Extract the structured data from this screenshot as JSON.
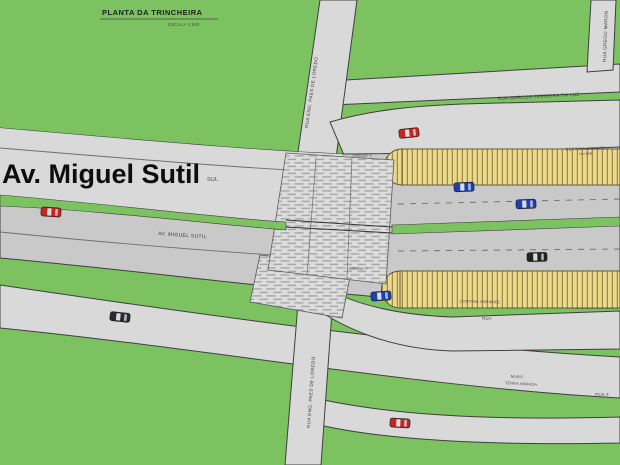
{
  "title": {
    "text": "PLANTA DA TRINCHEIRA",
    "subtitle": "ESCALA 1:500"
  },
  "overlay_label": {
    "text": "Av. Miguel Sutil",
    "suffix": "SUL"
  },
  "streets": {
    "avenue": "AV. MIGUEL SUTIL",
    "cross_street_north": "RUA ENG. PAES DE LOREDO",
    "cross_street_south": "RUA ENG. PAES DE LOREDO",
    "street_top_right": "RUA MARCOS FERREIRA DA LUZ",
    "street_far_right": "RUA GREGO MARON",
    "service_road": "RUA"
  },
  "annotations": {
    "upper_wall": "CORTINA VARIAVEL",
    "upper_wall_height": "H=VAR",
    "lower_wall": "CORTINA VARIAVEL",
    "grade_upper": "GREIDE 9",
    "grade_lower": "GREIDE 7",
    "retaining_wall_line1": "MURO",
    "retaining_wall_line2": "TERRA ARMADA",
    "sheet_ref": "PLN 4"
  },
  "colors": {
    "grass": "#7cc261",
    "road": "#d9d9d9",
    "road_dark": "#c9c9c9",
    "wall_yellow": "#ecd98b",
    "outline": "#3f3f3f"
  },
  "cars": [
    {
      "x": 409,
      "y": 133,
      "rot": -6,
      "color": "#c3271f"
    },
    {
      "x": 464,
      "y": 187,
      "rot": -2,
      "color": "#1f3fae"
    },
    {
      "x": 526,
      "y": 204,
      "rot": -2,
      "color": "#1f3fae"
    },
    {
      "x": 537,
      "y": 257,
      "rot": -1,
      "color": "#222222"
    },
    {
      "x": 381,
      "y": 296,
      "rot": -4,
      "color": "#1f3fae"
    },
    {
      "x": 51,
      "y": 212,
      "rot": 4,
      "color": "#c3271f"
    },
    {
      "x": 120,
      "y": 317,
      "rot": 6,
      "color": "#2b2b2b"
    },
    {
      "x": 400,
      "y": 423,
      "rot": 3,
      "color": "#c3271f"
    }
  ]
}
